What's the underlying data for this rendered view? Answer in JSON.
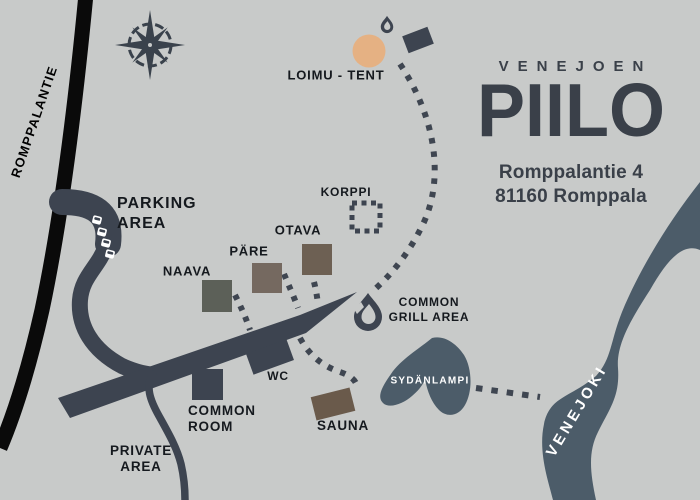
{
  "map": {
    "colors": {
      "background": "#c8cac9",
      "ink": "#3d4450",
      "public_road": "#0a0a0a",
      "water": "#4c5c69",
      "tent_spot": "#e5b183",
      "naava_building": "#5c6058",
      "pare_building": "#756960",
      "otava_building": "#6d6053",
      "sauna_building": "#6a5a4b",
      "label_text": "#15191e",
      "brand_text": "#3a4049"
    },
    "brand": {
      "top": "VENEJOEN",
      "name": "PIILO",
      "address_line1": "Romppalantie 4",
      "address_line2": "81160 Romppala"
    },
    "waterways": {
      "river": "VENEJOKI",
      "lake": "SYDÄNLAMPI"
    },
    "roads": {
      "public_road": "ROMPPALANTIE"
    },
    "areas": {
      "parking_line1": "PARKING",
      "parking_line2": "AREA",
      "grill_line1": "COMMON",
      "grill_line2": "GRILL AREA",
      "common_room_line1": "COMMON",
      "common_room_line2": "ROOM",
      "private_line1": "PRIVATE",
      "private_line2": "AREA"
    },
    "locations": {
      "loimu_tent": "LOIMU - TENT",
      "korppi": "KORPPI",
      "otava": "OTAVA",
      "pare": "PÄRE",
      "naava": "NAAVA",
      "wc": "WC",
      "sauna": "SAUNA"
    },
    "icons": [
      "compass-rose-icon",
      "campfire-icon",
      "grill-flame-icon",
      "car-icon",
      "korppi-dashed-marker"
    ]
  }
}
